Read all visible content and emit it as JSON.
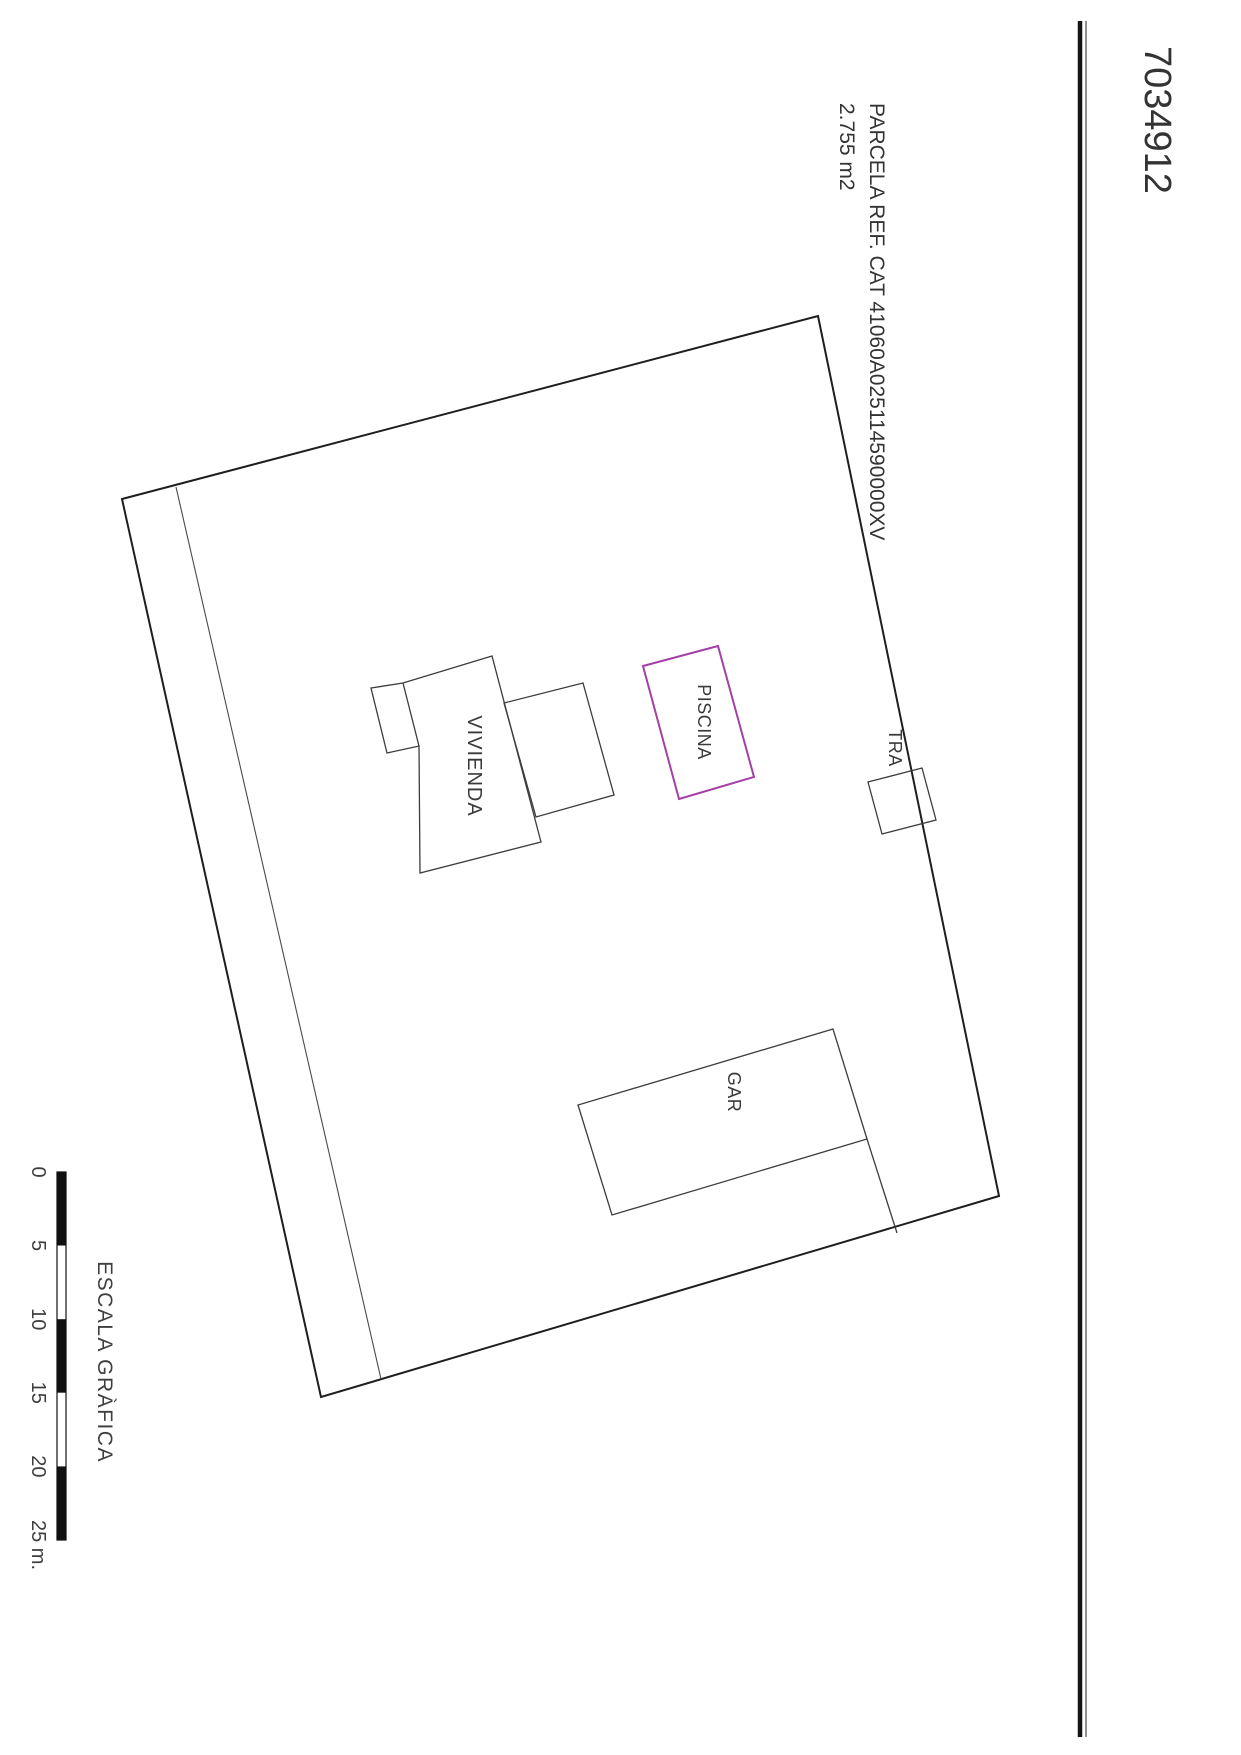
{
  "header": {
    "plot_number": "7034912",
    "ref_label": "PARCELA REF. CAT 41060A025114590000XV",
    "area_label": "2.755 m2"
  },
  "plan": {
    "labels": {
      "vivienda": "VIVIENDA",
      "piscina": "PISCINA",
      "tra": "TRA",
      "gar": "GAR"
    },
    "piscina_color": "#A43FA6",
    "outline_color": "#1e1e1e"
  },
  "scalebar": {
    "title": "ESCALA GRÀFICA",
    "ticks": [
      "0",
      "5",
      "10",
      "15",
      "20",
      "25 m."
    ],
    "bar_color": "#111111"
  }
}
